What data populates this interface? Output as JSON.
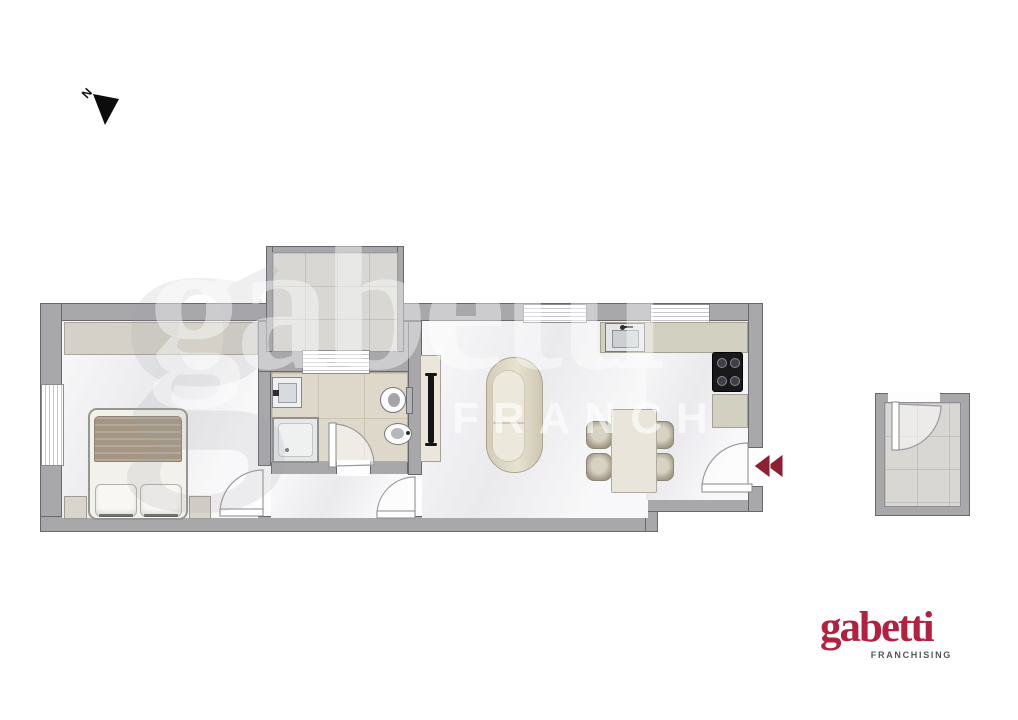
{
  "north": {
    "label": "N",
    "icon": "north-arrow-icon"
  },
  "entry": {
    "icon": "entry-direction-chevrons",
    "direction": "left"
  },
  "watermark": {
    "glyph": "g",
    "brand": "gabetti",
    "partial": "FRANCH"
  },
  "logo": {
    "brand": "gabetti",
    "tagline": "FRANCHISING"
  },
  "colors": {
    "wall": "#a8a8ab",
    "wall-line": "#68686c",
    "floor": "#f2f2f4",
    "bath-floor": "#ded8ca",
    "tile": "#d8d7d4",
    "counter": "#d2d0c0",
    "blanket": "#a49683",
    "accent-red": "#8e1f33",
    "logo-red": "#b22240",
    "logo-gray": "#55565a"
  }
}
